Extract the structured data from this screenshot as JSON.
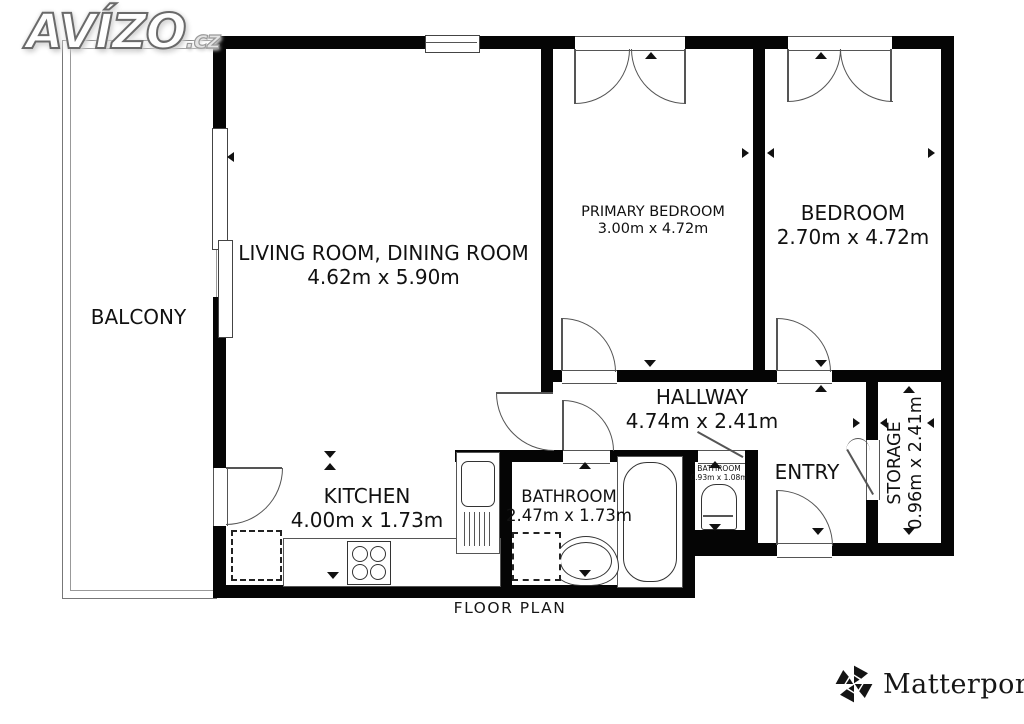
{
  "branding": {
    "avizo": "AVÍZO",
    "avizo_suffix": ".cz",
    "matterport": "Matterport",
    "matterport_reg": "®"
  },
  "caption": "FLOOR PLAN",
  "rooms": {
    "balcony": {
      "name": "BALCONY"
    },
    "living_room": {
      "name": "LIVING ROOM, DINING ROOM",
      "dims": "4.62m x 5.90m"
    },
    "primary_bedroom": {
      "name": "PRIMARY BEDROOM",
      "dims": "3.00m x 4.72m"
    },
    "bedroom": {
      "name": "BEDROOM",
      "dims": "2.70m x 4.72m"
    },
    "hallway": {
      "name": "HALLWAY",
      "dims": "4.74m x 2.41m"
    },
    "kitchen": {
      "name": "KITCHEN",
      "dims": "4.00m x 1.73m"
    },
    "bathroom": {
      "name": "BATHROOM",
      "dims": "2.47m x 1.73m"
    },
    "small_bathroom": {
      "name": "BATHROOM",
      "dims": "0.93m x 1.08m"
    },
    "entry": {
      "name": "ENTRY"
    },
    "storage": {
      "name": "STORAGE",
      "dims": "0.96m x 2.41m"
    }
  },
  "colors": {
    "wall": "#050505",
    "line": "#555555",
    "text": "#111111",
    "background": "#ffffff"
  }
}
